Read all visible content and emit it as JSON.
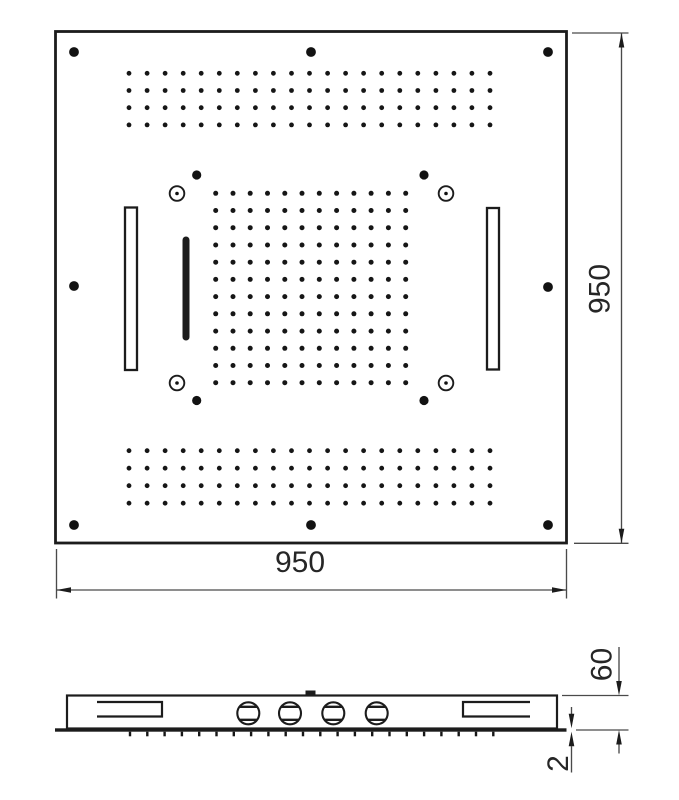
{
  "dimensions": {
    "plate_width": {
      "value": "950"
    },
    "plate_height": {
      "value": "950"
    },
    "depth": {
      "value": "60"
    },
    "panel_edge": {
      "value": "2"
    }
  },
  "nozzle_fields": {
    "top_band": {
      "type": "dotgrid",
      "x0": 129.0,
      "y0": 73.3,
      "dx": 18.05,
      "dy": 17.2,
      "cols": 21,
      "rows": 4,
      "r": 2.4
    },
    "center_grid": {
      "type": "dotgrid",
      "x0": 215.7,
      "y0": 193.3,
      "dx": 17.27,
      "dy": 17.22,
      "cols": 12,
      "rows": 12,
      "r": 2.5
    },
    "bottom_band": {
      "type": "dotgrid",
      "x0": 129.0,
      "y0": 450.7,
      "dx": 18.05,
      "dy": 17.5,
      "cols": 21,
      "rows": 4,
      "r": 2.4
    },
    "side_nozzles": {
      "type": "ticks",
      "x0": 130.0,
      "dx": 17.3,
      "count": 22,
      "y1": 731.7,
      "y2": 736.3
    }
  },
  "colors": {
    "line": "#1c1c1c",
    "dim_line": "#4a4a4a",
    "text": "#262626",
    "background": "#ffffff"
  }
}
